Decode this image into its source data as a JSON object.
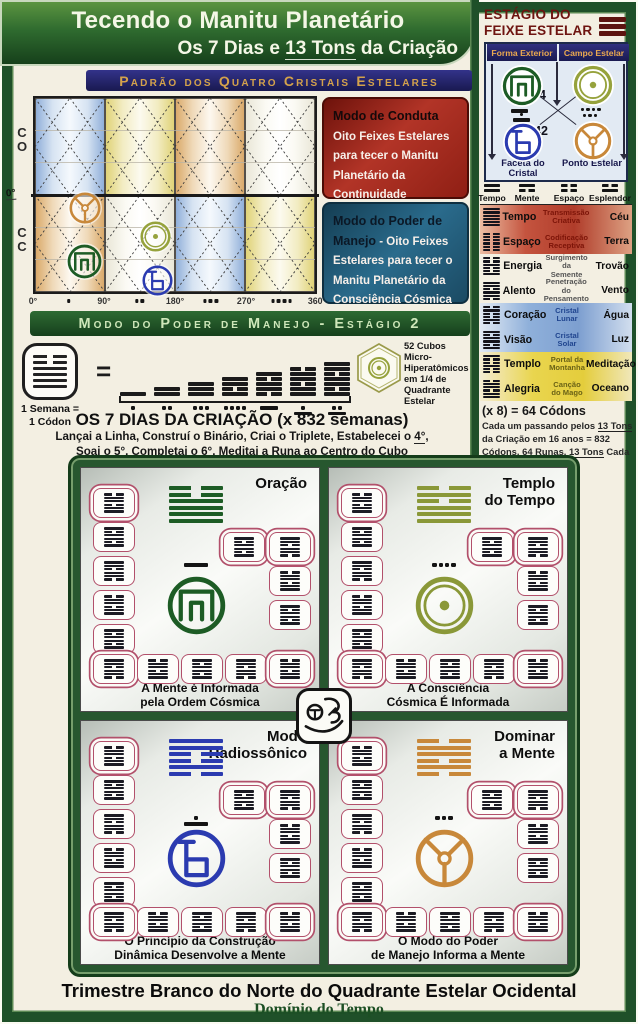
{
  "page": {
    "title": "Tecendo o Manitu Planetário",
    "subtitle_pre": "Os 7 Dias e ",
    "subtitle_u": "13 Tons",
    "subtitle_post": " da Criação",
    "footer1": "Trimestre Branco do Norte do Quadrante Estelar Ocidental",
    "footer2": "Domínio do Tempo"
  },
  "pattern_bar": "Padrão dos Quatro Cristais Estelares",
  "stage2_bar": "Modo do Poder de Manejo - Estágio 2",
  "chart": {
    "row1": [
      "C",
      "O"
    ],
    "row2": [
      "C",
      "C"
    ],
    "mid_label": "0°",
    "x_labels": [
      "0°",
      "90°",
      "180°",
      "270°",
      "360°"
    ],
    "between_dots": [
      1,
      2,
      3,
      4
    ],
    "cells_top": [
      "blue",
      "yellow",
      "tan",
      "plain"
    ],
    "cells_bottom": [
      "tan",
      "plain",
      "blue",
      "yellow"
    ],
    "glyphs": [
      {
        "type": "trispoke",
        "color": "#c8883a",
        "x": 35,
        "y": 95,
        "size": 34
      },
      {
        "type": "meander",
        "color": "#1d5c25",
        "x": 33,
        "y": 147,
        "size": 37
      },
      {
        "type": "circledot",
        "color": "#96a23c",
        "x": 106,
        "y": 124,
        "size": 33
      },
      {
        "type": "bglyph",
        "color": "#2b3bb0",
        "x": 108,
        "y": 168,
        "size": 33
      }
    ]
  },
  "mode_boxes": {
    "conduct_title": "Modo de Conduta",
    "conduct_body": "Oito Feixes Estelares para tecer o Manitu Planetário da Continuidade Originária",
    "manejo_title": "Modo do Poder de Manejo",
    "manejo_sep": " - ",
    "manejo_body": "Oito Feixes Estelares para tecer o Manitu Planetário da Consciência Cósmica"
  },
  "week_band": {
    "legend1": "1 Semana =",
    "legend2": "1 Códon",
    "equals": "=",
    "codon_hex": "001111",
    "days": 7,
    "cubes_text": "52 Cubos Micro-Hiperatômicos em 1/4 de Quadrante Estelar",
    "heading": "OS 7 DIAS DA CRIAÇÃO (x 832 semanas)",
    "l1_pre": "Lançai a Linha, Construí o Binário, Criai o Triplete, Estabelecei o ",
    "l1_u": "4°",
    "l1_post": ",",
    "l2_pre": "Soai o ",
    "l2_u1": "5°",
    "l2_mid": ", Completai o ",
    "l2_u2": "6°",
    "l2_post": ", Meditai a Runa ao Centro do Cubo"
  },
  "stage_panel": {
    "title1": "ESTÁGIO DO",
    "title2": "FEIXE ESTELAR",
    "headers": [
      "Forma Exterior",
      "Campo Estelar"
    ],
    "numbers": [
      "34",
      "26",
      "42",
      "18"
    ],
    "label_bl": "Faceta do Cristal",
    "label_br": "Ponto Estelar",
    "quad_glyphs": [
      {
        "type": "meander",
        "color": "#1d5c25",
        "tone": 5
      },
      {
        "type": "circledot",
        "color": "#96a23c",
        "tone": 4
      },
      {
        "type": "bglyph",
        "color": "#2b3bb0",
        "tone": 6
      },
      {
        "type": "trispoke",
        "color": "#c8883a",
        "tone": 3
      }
    ]
  },
  "codon_table": {
    "headers": [
      {
        "label": "Tempo",
        "digram": "11"
      },
      {
        "label": "Mente",
        "digram": "10"
      },
      {
        "label": "Espaço",
        "digram": "00"
      },
      {
        "label": "Esplendor",
        "digram": "01"
      }
    ],
    "rows": [
      {
        "hex": "111111",
        "name": "Tempo",
        "desc": "Transmissão Criativa",
        "element": "Céu",
        "bg": "red",
        "desc_color": "#7c1408"
      },
      {
        "hex": "000000",
        "name": "Espaço",
        "desc": "Codificação Receptiva",
        "element": "Terra",
        "bg": "red",
        "desc_color": "#7c1408"
      },
      {
        "hex": "001001",
        "name": "Energia",
        "desc": "Surgimento da Semente",
        "element": "Trovão",
        "bg": "white",
        "desc_color": "#555555"
      },
      {
        "hex": "110110",
        "name": "Alento",
        "desc": "Penetração do Pensamento",
        "element": "Vento",
        "bg": "white",
        "desc_color": "#555555"
      },
      {
        "hex": "010010",
        "name": "Coração",
        "desc": "Cristal Lunar",
        "element": "Água",
        "bg": "blue",
        "desc_color": "#20458f"
      },
      {
        "hex": "101101",
        "name": "Visão",
        "desc": "Cristal Solar",
        "element": "Luz",
        "bg": "blue",
        "desc_color": "#20458f"
      },
      {
        "hex": "100100",
        "name": "Templo",
        "desc": "Portal da Montanha",
        "element": "Meditação",
        "bg": "yellow",
        "desc_color": "#6b6316"
      },
      {
        "hex": "011011",
        "name": "Alegria",
        "desc": "Canção do Mago",
        "element": "Oceano",
        "bg": "yellow",
        "desc_color": "#6b6316"
      }
    ],
    "foot0": "(x 8) = 64 Códons",
    "foot1_pre": "Cada um passando pelos ",
    "foot1_u": "13 Tons",
    "foot2": "da Criação em 16 anos = 832",
    "foot3_pre": "Códons, 64 Runas, ",
    "foot3_u": "13 Tons",
    "foot3_post": " Cada"
  },
  "panels": [
    {
      "title1": "Oração",
      "title2": "",
      "cap1": "A Mente é Informada",
      "cap2": "pela Ordem Cósmica",
      "color": "#1d5c25",
      "glyph": "meander",
      "tone": 5,
      "hex": "001111"
    },
    {
      "title1": "Templo",
      "title2": "do Tempo",
      "cap1": "A Consciência",
      "cap2": "Cósmica É Informada",
      "color": "#8a9838",
      "glyph": "circledot",
      "tone": 4,
      "hex": "010111"
    },
    {
      "title1": "Modo",
      "title2": "Radiossônico",
      "cap1": "O Princípio da Construção",
      "cap2": "Dinâmica Desenvolve a Mente",
      "color": "#2b3bb0",
      "glyph": "bglyph",
      "tone": 6,
      "hex": "110010"
    },
    {
      "title1": "Dominar",
      "title2": "a Mente",
      "cap1": "O Modo do Poder",
      "cap2": "de Manejo Informa a Mente",
      "color": "#c8883a",
      "glyph": "trispoke",
      "tone": 3,
      "hex": "011010"
    }
  ]
}
